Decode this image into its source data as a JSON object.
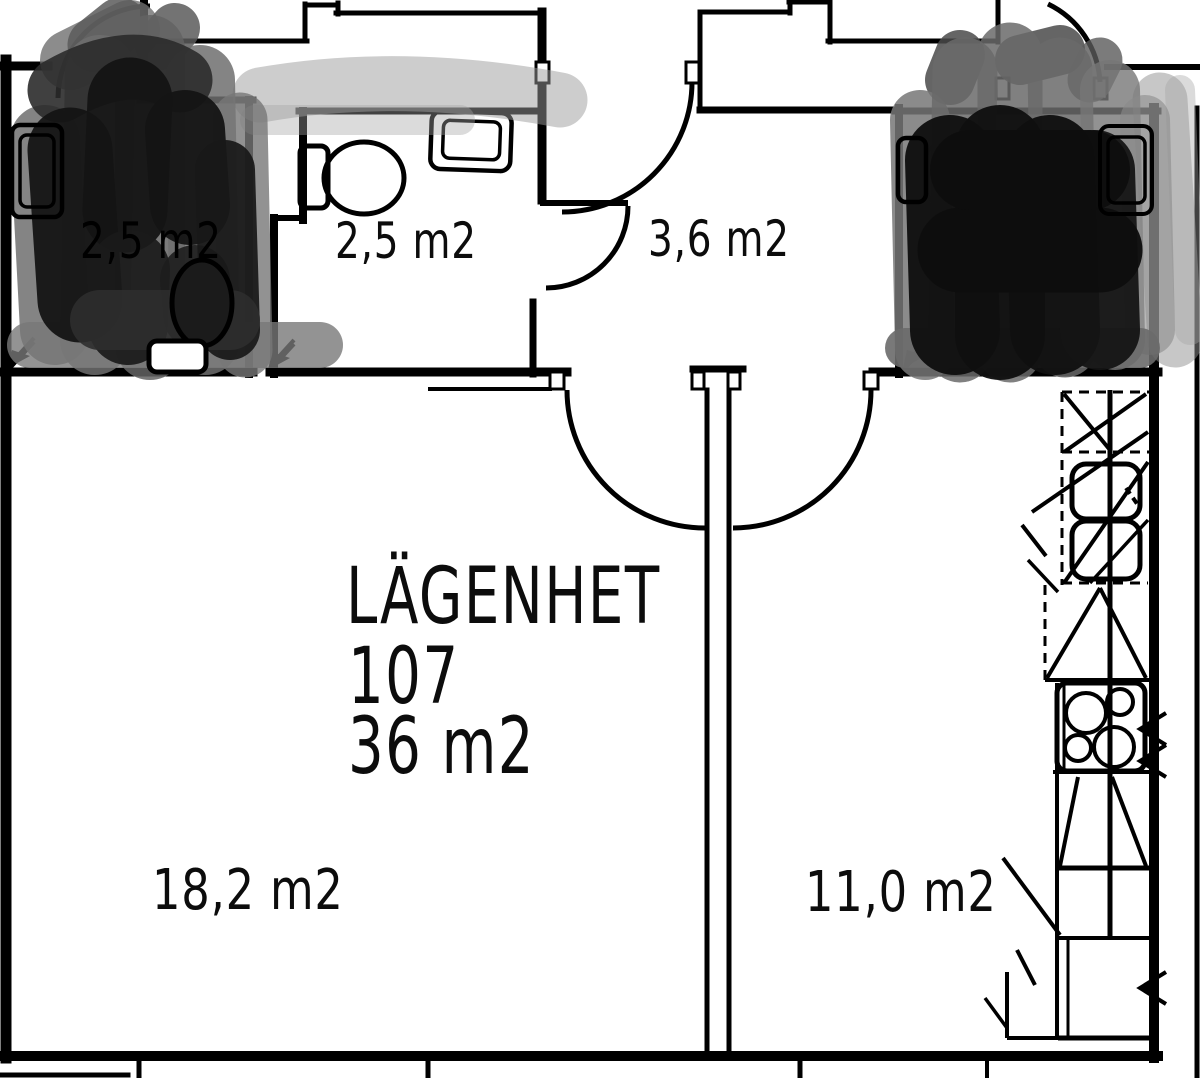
{
  "plan": {
    "title_block": {
      "line1": "LÄGENHET",
      "line2": "107",
      "line3": "36 m2"
    },
    "rooms": {
      "bathroom_left": {
        "label": "2,5 m2"
      },
      "bathroom": {
        "label": "2,5 m2"
      },
      "hall": {
        "label": "3,6 m2"
      },
      "living_room": {
        "label": "18,2 m2"
      },
      "kitchen_room": {
        "label": "11,0 m2"
      }
    },
    "colors": {
      "line": "#000000",
      "background": "#ffffff",
      "redaction_dark": "#141414",
      "redaction_mid": "#555555"
    }
  }
}
